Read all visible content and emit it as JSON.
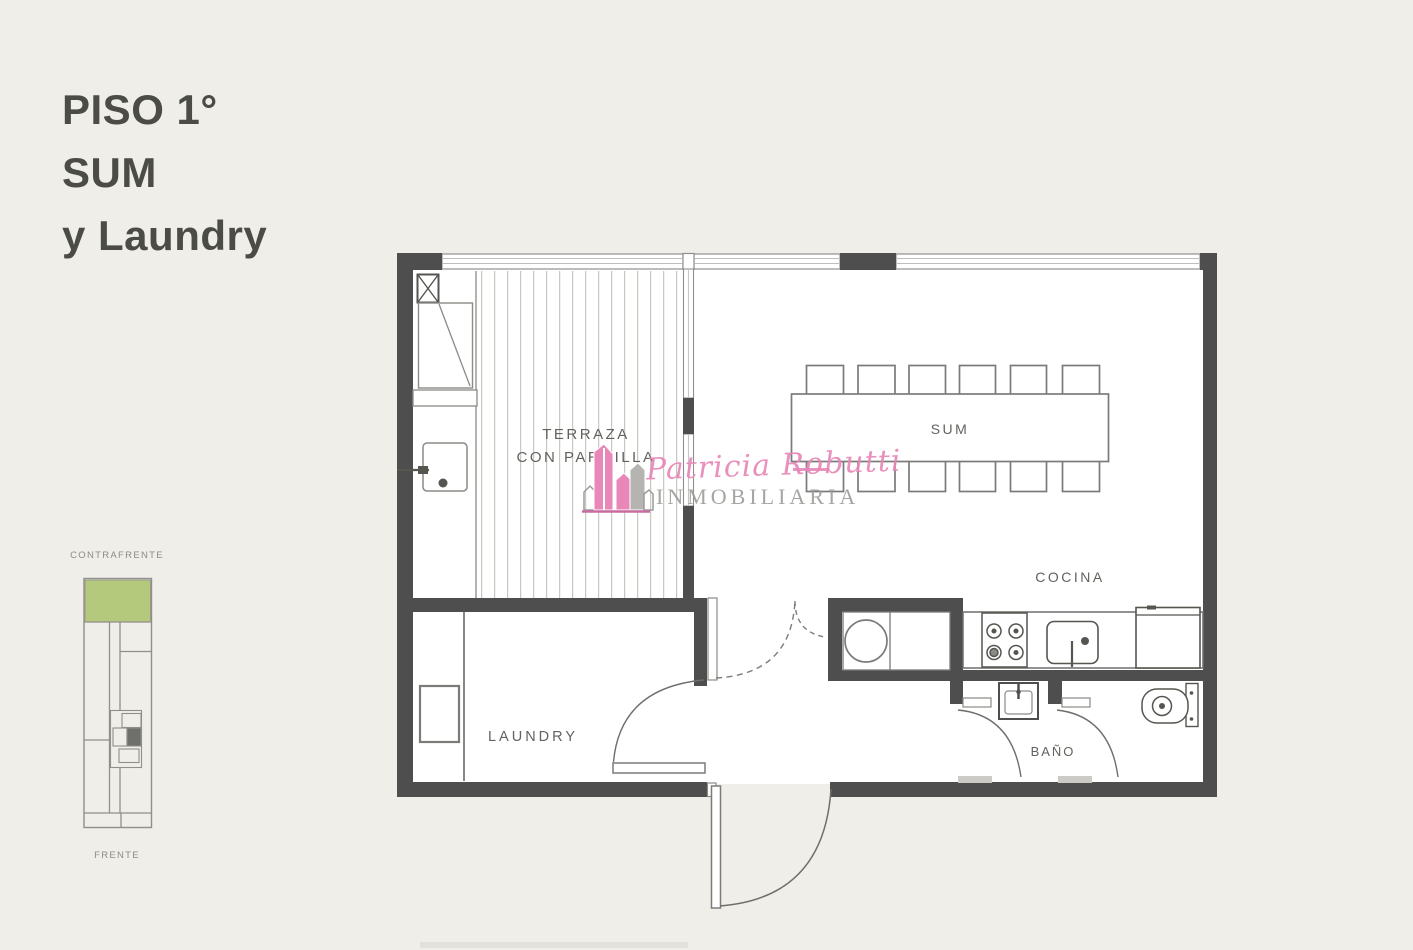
{
  "page": {
    "background_color": "#efeee8"
  },
  "title": {
    "line1": "PISO 1°",
    "line2": "SUM",
    "line3": "y Laundry"
  },
  "room_labels": {
    "terraza_line1": "TERRAZA",
    "terraza_line2": "CON PARRILLA",
    "sum": "SUM",
    "cocina": "COCINA",
    "laundry": "LAUNDRY",
    "bano": "BAÑO"
  },
  "key_plan": {
    "top_label": "CONTRAFRENTE",
    "bottom_label": "FRENTE",
    "highlight_color": "#b5c97c"
  },
  "watermark": {
    "name": "Patricia Robutti",
    "subtitle": "INMOBILIARIA",
    "logo_icon": "buildings-logo-icon",
    "accent_color": "#e887b8"
  },
  "colors": {
    "wall": "#4e4e4e",
    "thin_line": "#7b7b78",
    "deck_stripe": "#c9c8c3",
    "glazing": "#8f8f8f"
  }
}
